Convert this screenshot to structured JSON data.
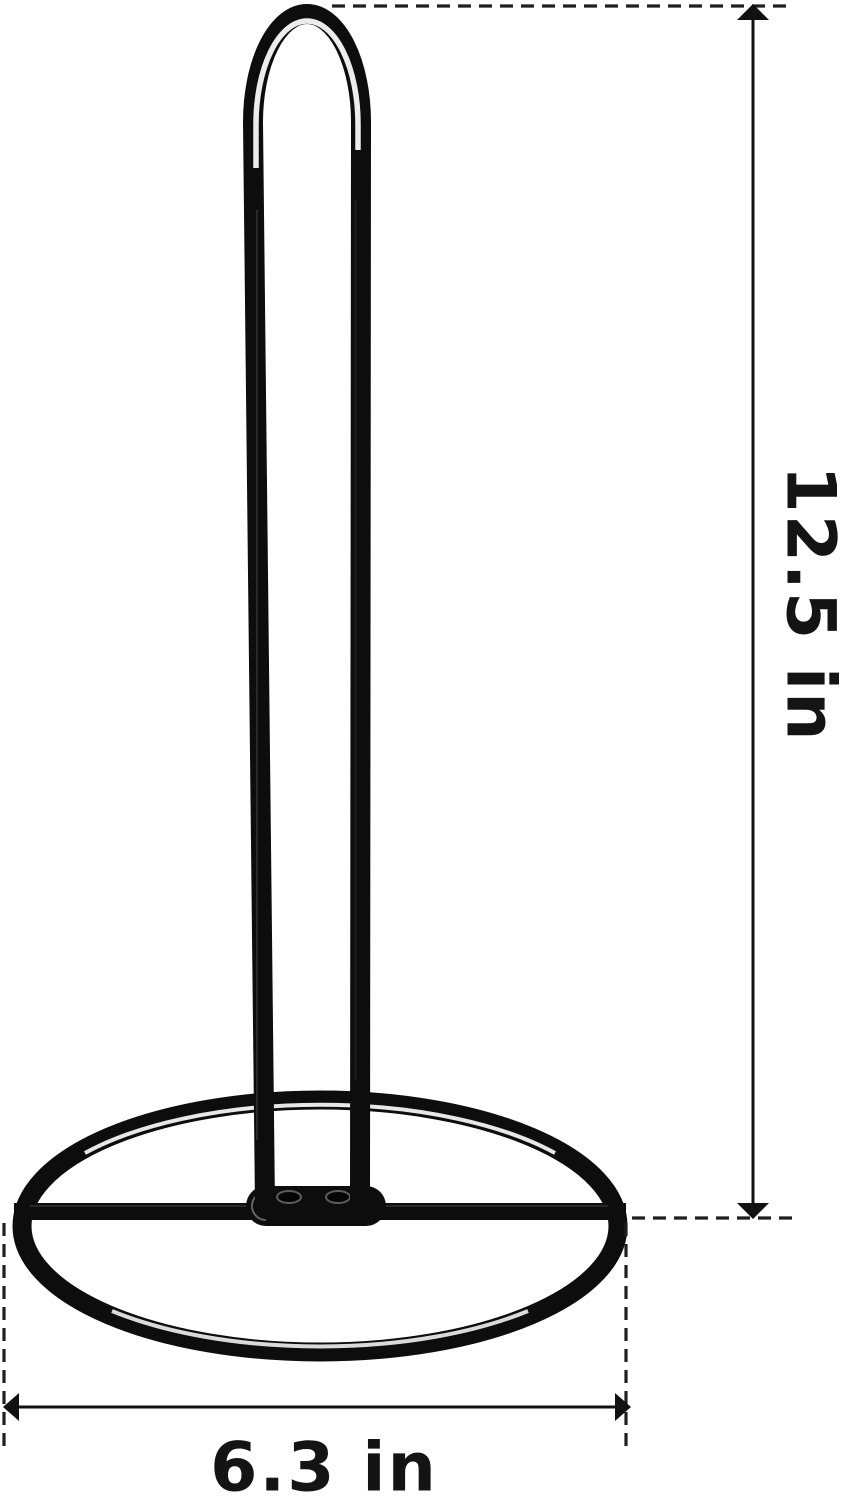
{
  "product": {
    "name": "paper-towel-holder",
    "body_color": "#0d0d0d",
    "highlight_color": "#ffffff"
  },
  "dimensions": {
    "height_label": "12.5 in",
    "height_value_in": 12.5,
    "width_label": "6.3 in",
    "width_value_in": 6.3
  },
  "style": {
    "annotation_line_color": "#1f1f1f",
    "arrow_color": "#111111",
    "text_color": "#141414",
    "background_color": "#ffffff"
  }
}
